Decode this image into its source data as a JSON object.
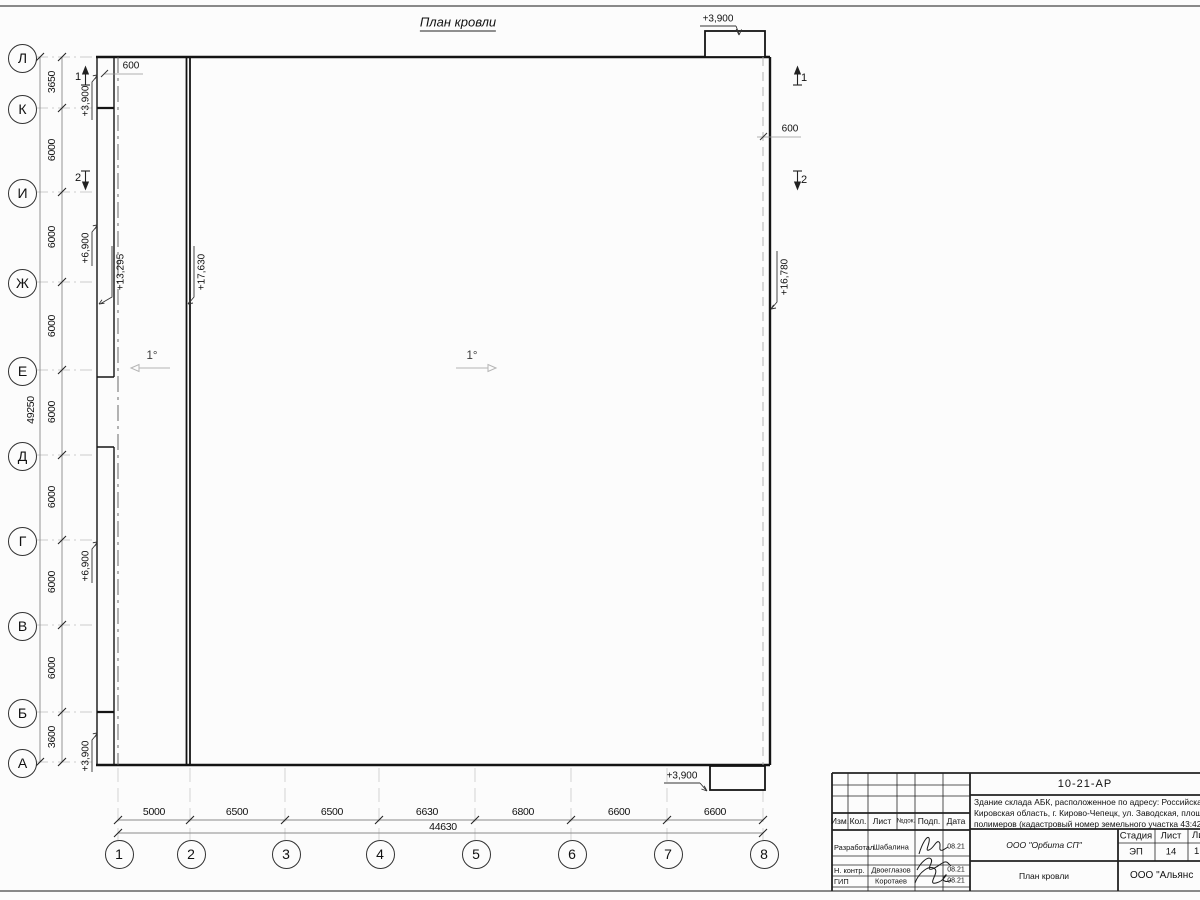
{
  "sheet": {
    "title": "План кровли"
  },
  "axes": {
    "rows": [
      "Л",
      "К",
      "И",
      "Ж",
      "Е",
      "Д",
      "Г",
      "В",
      "Б",
      "А"
    ],
    "row_dims": [
      "3650",
      "6000",
      "6000",
      "6000",
      "6000",
      "6000",
      "6000",
      "6000",
      "3600"
    ],
    "row_total": "49250",
    "cols": [
      "1",
      "2",
      "3",
      "4",
      "5",
      "6",
      "7",
      "8"
    ],
    "col_dims": [
      "5000",
      "6500",
      "6500",
      "6630",
      "6800",
      "6600",
      "6600"
    ],
    "col_total": "44630"
  },
  "annotations": {
    "offset_left": "600",
    "offset_right": "600",
    "elev_top_box": "+3,900",
    "elev_bottom_box": "+3,900",
    "elev_k": "+3,900",
    "elev_zh": "+6,900",
    "elev_g": "+6,900",
    "elev_a": "+3,900",
    "elev_low_roof": "+13,295",
    "elev_ridge": "+17,630",
    "elev_right_edge": "+16,780",
    "slope_left": "1°",
    "slope_right": "1°",
    "section_1": "1",
    "section_2": "2"
  },
  "title_block": {
    "doc_number": "10-21-АР",
    "description_line1": "Здание склада АБК, расположенное по адресу: Российская Феде",
    "description_line2": "Кировская область, г. Кирово-Чепецк, ул. Заводская, площадка з",
    "description_line3": "полимеров (кадастровый номер земельного участка 43:42:00000",
    "col_izm": "Изм.",
    "col_kol": "Кол.",
    "col_list": "Лист",
    "col_ndok": "№док.",
    "col_podp": "Подп.",
    "col_data": "Дата",
    "role1": "Разработал",
    "name1": "Шабалина",
    "date1": "08.21",
    "role2": "Н. контр.",
    "name2": "Двоеглазов",
    "date2": "08.21",
    "role3": "ГИП",
    "name3": "Коротаев",
    "date3": "08.21",
    "company": "ООО \"Орбита СП\"",
    "stage_label": "Стадия",
    "sheet_label": "Лист",
    "sheets_label": "Ли",
    "stage": "ЭП",
    "sheet_num": "14",
    "sheets_num": "1",
    "drawing_name": "План кровли",
    "org": "ООО \"Альянс"
  }
}
